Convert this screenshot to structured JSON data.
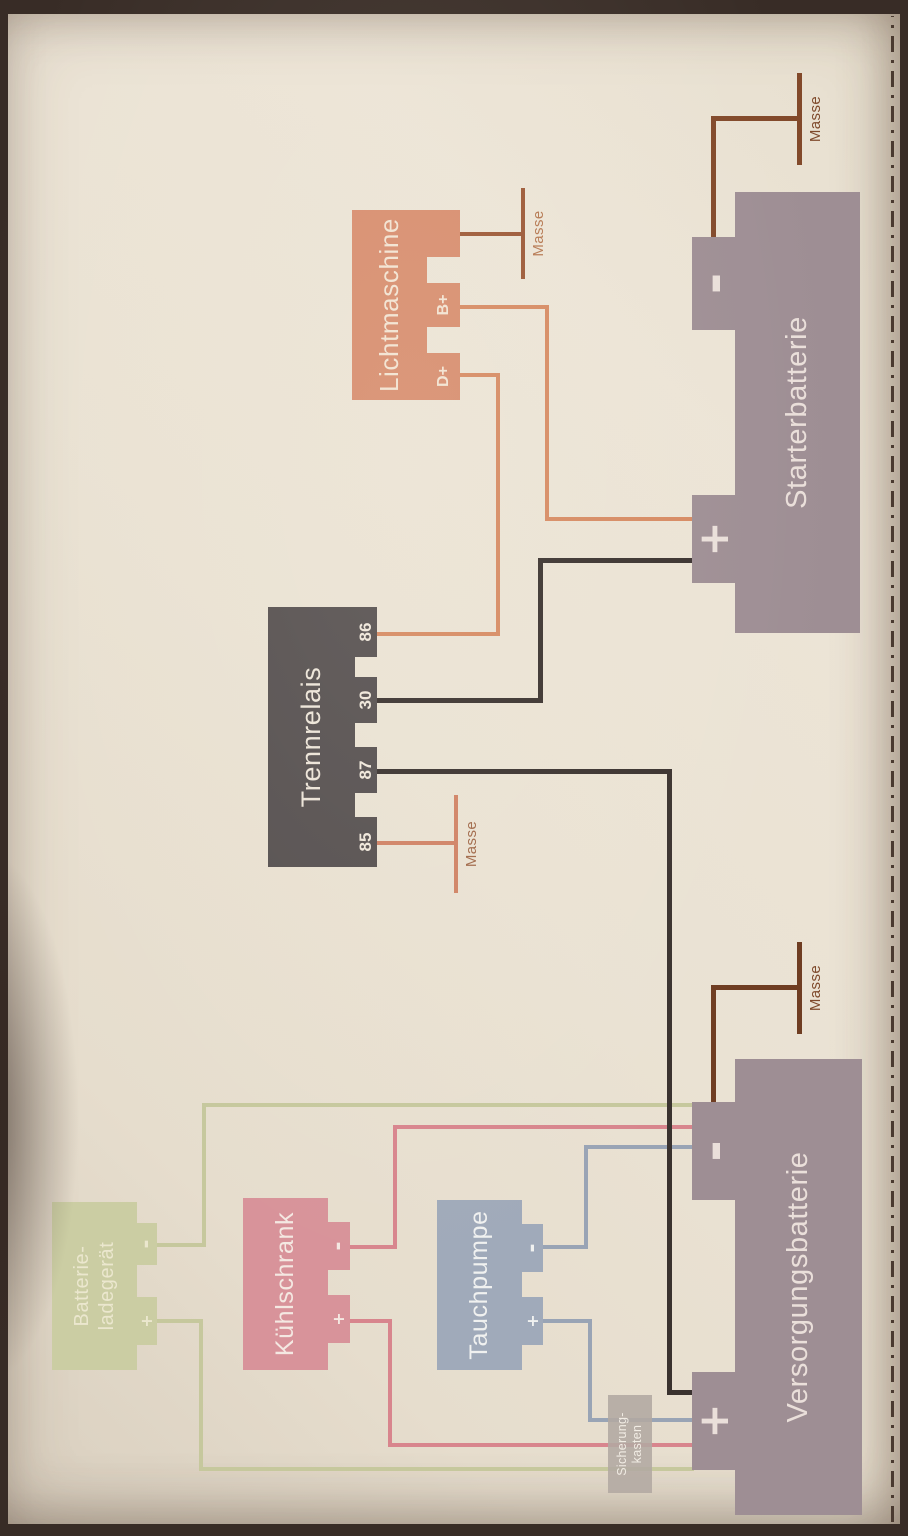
{
  "diagram": {
    "blocks": {
      "lichtmaschine": {
        "title": "Lichtmaschine",
        "terminals": [
          "D+",
          "B+"
        ]
      },
      "trennrelais": {
        "title": "Trennrelais",
        "terminals": [
          "85",
          "87",
          "30",
          "86"
        ]
      },
      "starterbatterie": {
        "title": "Starterbatterie",
        "plus": "+",
        "minus": "-"
      },
      "versorgungsbatterie": {
        "title": "Versorgungsbatterie",
        "plus": "+",
        "minus": "-"
      },
      "batterieladegeraet": {
        "title_line1": "Batterie-",
        "title_line2": "ladegerät",
        "plus": "+",
        "minus": "-"
      },
      "kuehlschrank": {
        "title": "Kühlschrank",
        "plus": "+",
        "minus": "-"
      },
      "tauchpumpe": {
        "title": "Tauchpumpe",
        "plus": "+",
        "minus": "-"
      },
      "sicherungskasten": {
        "title_line1": "Sicherung-",
        "title_line2": "kasten"
      }
    },
    "grounds": {
      "lichtmaschine": "Masse",
      "trennrelais": "Masse",
      "starterbatterie": "Masse",
      "versorgungsbatterie": "Masse"
    },
    "colors": {
      "paper": "#eae2d3",
      "photo_frame": "#382c26",
      "lichtmaschine_fill": "#d78d6e",
      "trennrelais_fill": "#565050",
      "battery_fill": "#9e8e94",
      "kuehlschrank_fill": "#d8939a",
      "tauchpumpe_fill": "#a0aaba",
      "ladegeraet_fill": "#cbcda3",
      "sicherungskasten_fill": "#b2a9a2",
      "wire_orange": "#d68a62",
      "wire_dark": "#3a322f",
      "wire_ground_brown": "#82492a",
      "wire_green": "#c6c89d",
      "wire_pink": "#d8858d",
      "wire_blue": "#99a4b5",
      "border_dashdot": "#4a3a30"
    }
  }
}
